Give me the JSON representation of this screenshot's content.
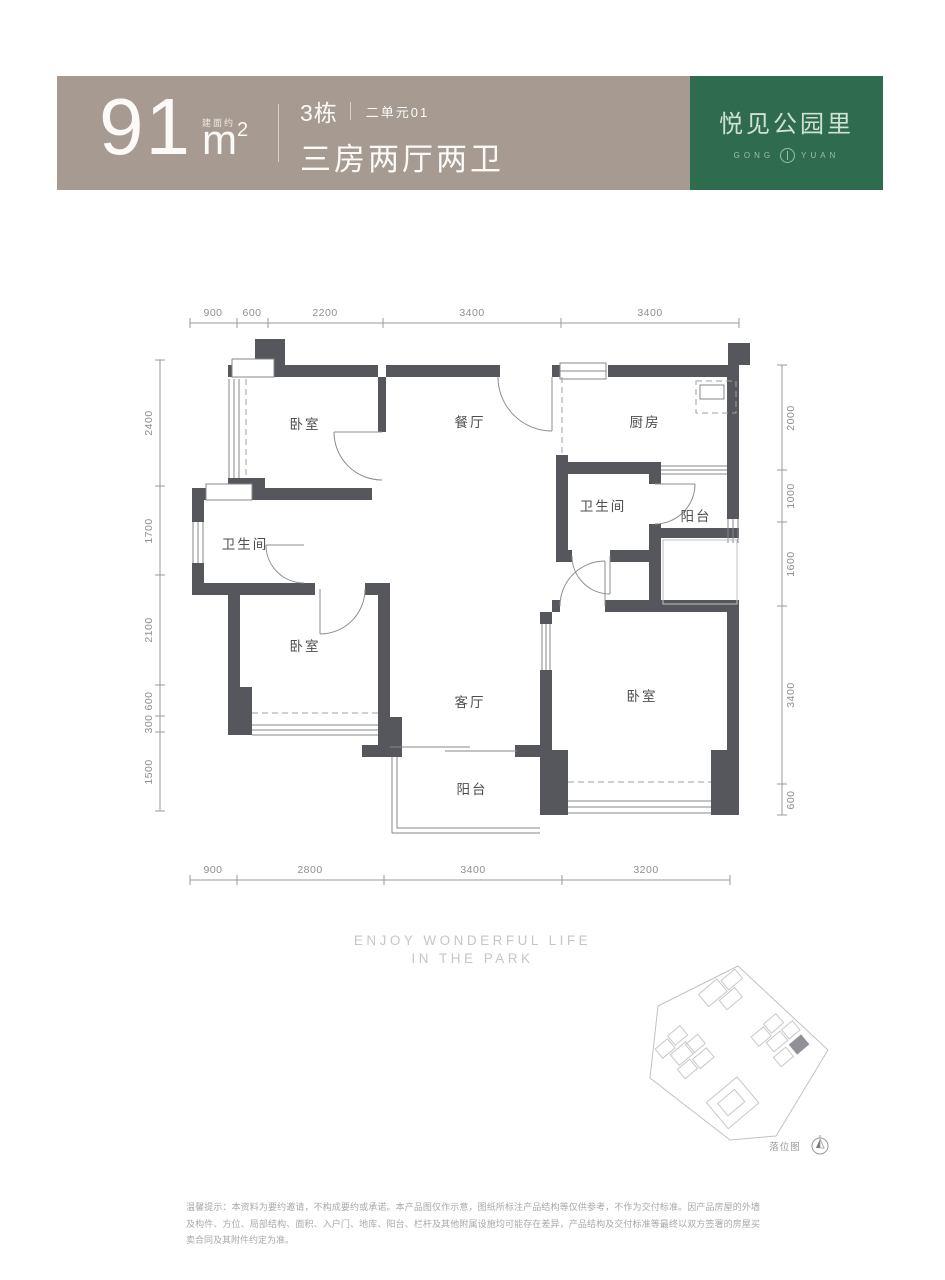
{
  "header": {
    "area_value": "91",
    "area_prefix": "建面约",
    "area_unit": "m",
    "area_sup": "2",
    "building": "3栋",
    "unit": "二单元01",
    "layout": "三房两厅两卫",
    "brand": {
      "name": "悦见公园里",
      "en_left": "GONG",
      "en_right": "YUAN"
    },
    "colors": {
      "band_bg": "#a79a91",
      "brand_bg": "#2f6b4d",
      "text": "#fbfaf7"
    }
  },
  "plan": {
    "wall_color": "#55575d",
    "dims": {
      "top": [
        "900",
        "600",
        "2200",
        "3400",
        "3400"
      ],
      "bottom": [
        "900",
        "2800",
        "3400",
        "3200"
      ],
      "left": [
        "2400",
        "1700",
        "2100",
        "600",
        "300",
        "1500"
      ],
      "right": [
        "2000",
        "1000",
        "1600",
        "3400",
        "600"
      ]
    },
    "rooms": {
      "bedroom_top_left": "卧室",
      "dining": "餐厅",
      "kitchen": "厨房",
      "bath_right": "卫生间",
      "balcony_right": "阳台",
      "bath_left": "卫生间",
      "bedroom_bottom_left": "卧室",
      "living": "客厅",
      "balcony_bottom": "阳台",
      "bedroom_bottom_right": "卧室"
    }
  },
  "footer": {
    "slogan_line1": "ENJOY WONDERFUL LIFE",
    "slogan_line2": "IN THE PARK",
    "sitemap_label": "落位图",
    "disclaimer": "温馨提示：本资料为要约邀请，不构成要约或承诺。本产品图仅作示意，图纸所标注产品结构等仅供参考，不作为交付标准。因产品房屋的外墙及构件、方位、局部结构、面积、入户门、地库、阳台、栏杆及其他附属设施均可能存在差异，产品结构及交付标准等最终以双方签署的房屋买卖合同及其附件约定为准。"
  }
}
